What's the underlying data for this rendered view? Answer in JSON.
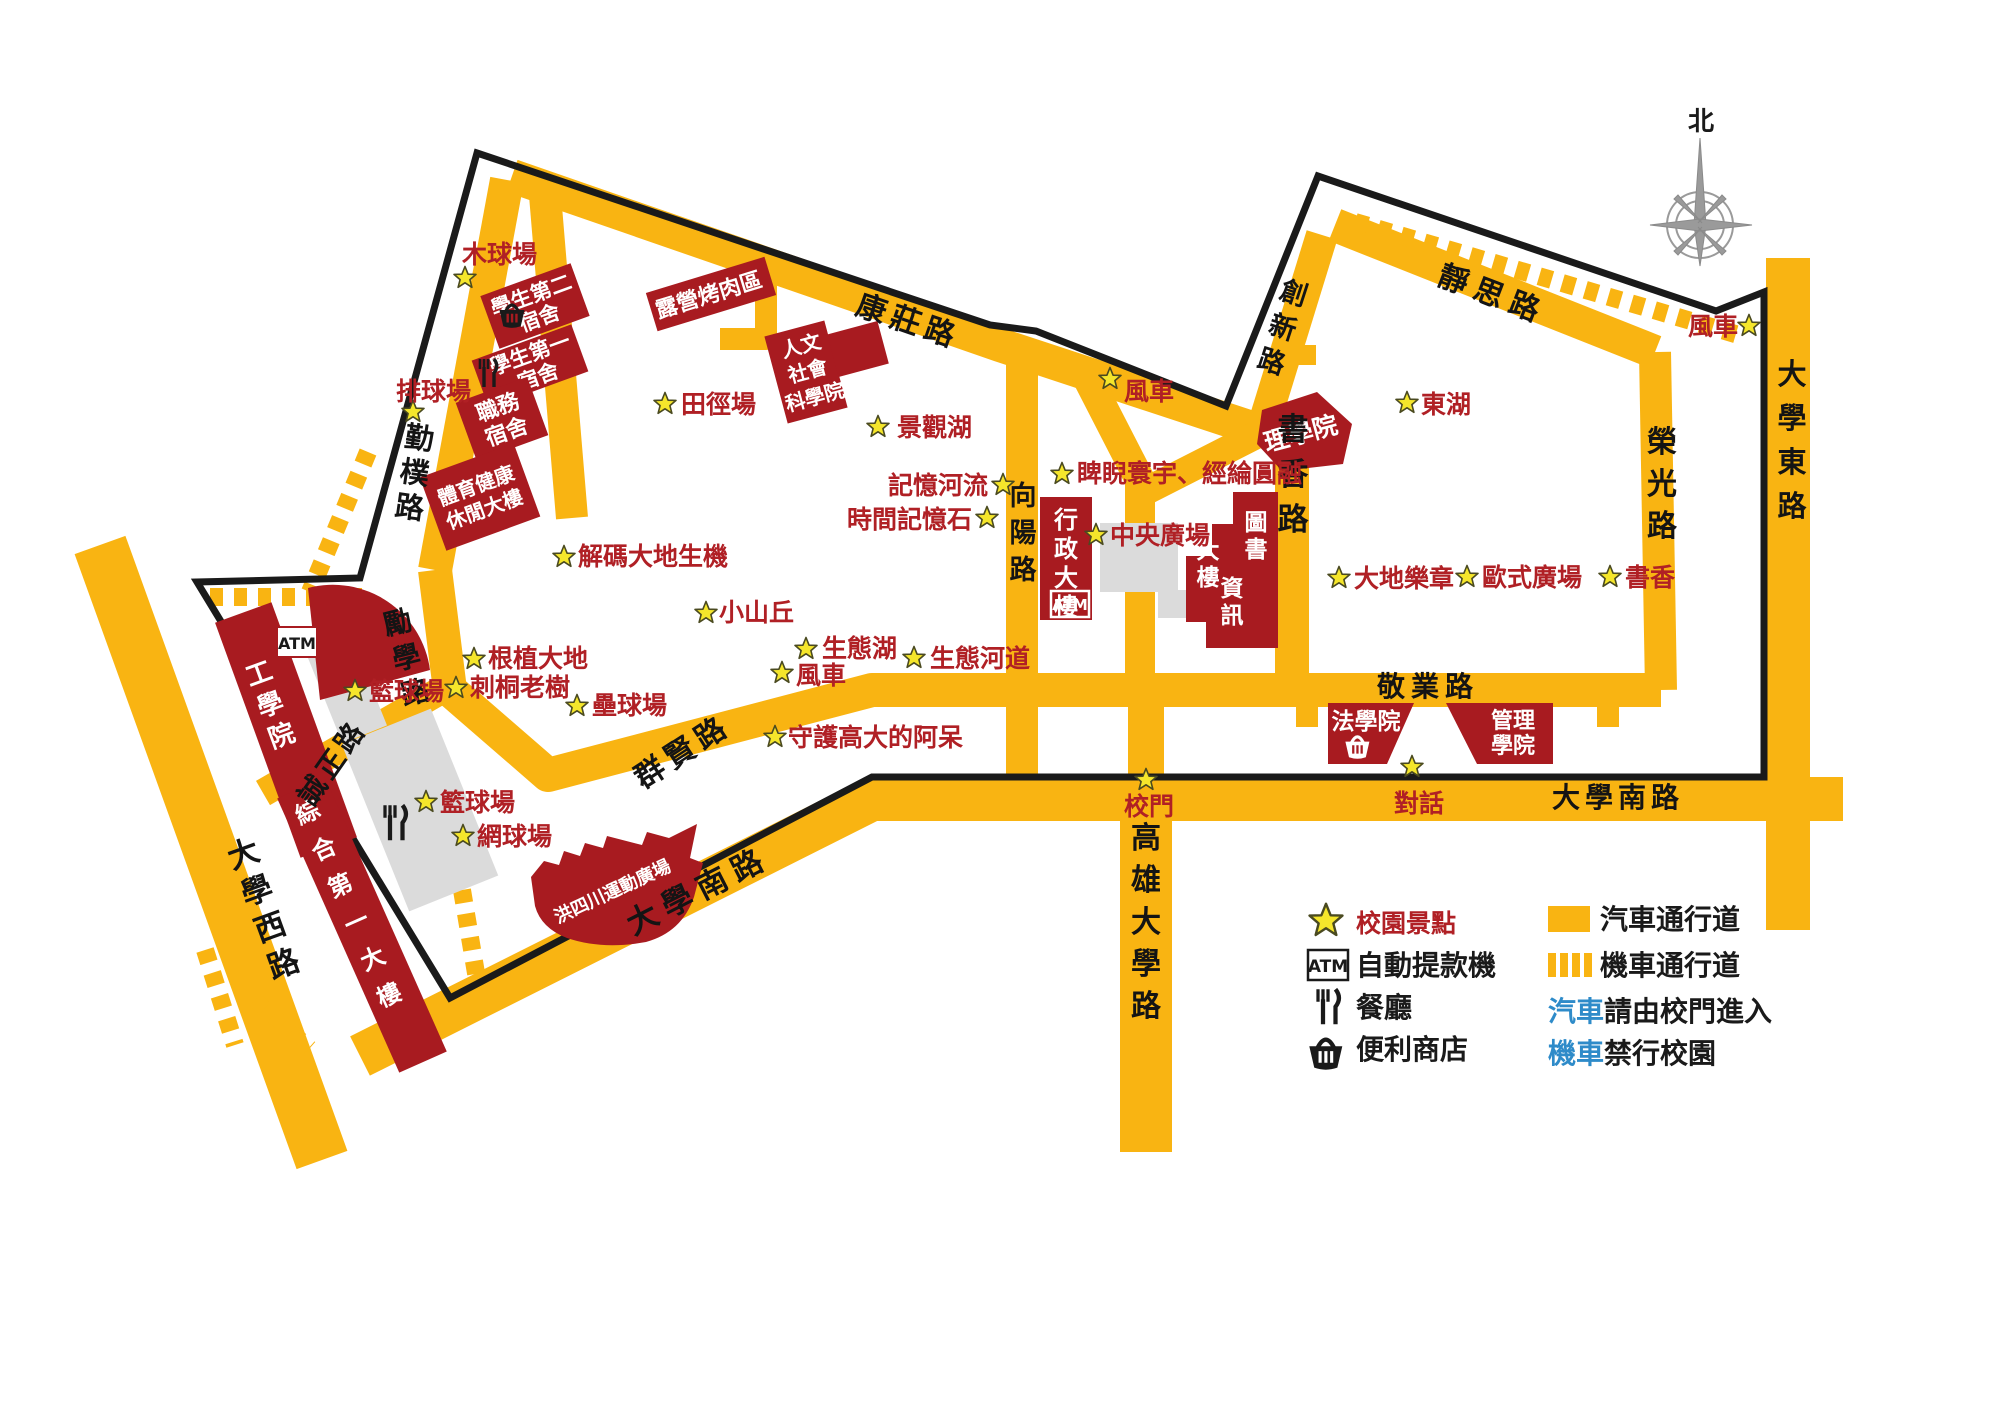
{
  "compass": {
    "north": "北"
  },
  "colors": {
    "road_yellow": "#F9B412",
    "building_red": "#A81B20",
    "label_red": "#B02025",
    "star_yellow": "#F5E62B",
    "note_blue": "#2E8BC9",
    "plaza_gray": "#DBDBDB",
    "boundary_black": "#1A1A1A"
  },
  "roads": {
    "qinpu": "勤樸路",
    "kangzhuang": "康莊路",
    "lixue": "勵學路",
    "chengzheng": "誠正路",
    "qunxian": "群賢路",
    "xiangyang": "向陽路",
    "chuangxin": "創新路",
    "shuxiang": "書香路",
    "jingsi": "靜思路",
    "rongguang": "榮光路",
    "jingye": "敬業路",
    "daxue_south": "大學南路",
    "daxue_west": "大學西路",
    "daxue_east": "大學東路",
    "gaoxiong": "高雄大學路"
  },
  "buildings": {
    "dorm2": {
      "l1": "學生第二",
      "l2": "宿舍"
    },
    "dorm1": {
      "l1": "學生第一",
      "l2": "宿舍"
    },
    "staff": {
      "l1": "職務",
      "l2": "宿舍"
    },
    "gym": {
      "l1": "體育健康",
      "l2": "休閒大樓"
    },
    "camp": {
      "l1": "露營烤肉區"
    },
    "hum": {
      "l1": "人文",
      "l2": "社會",
      "l3": "科學院"
    },
    "sci": {
      "l1": "理學院"
    },
    "admin": {
      "name": "行政大樓",
      "atm": "ATM"
    },
    "lib": {
      "c1": "圖書",
      "c2": "資訊",
      "c3": "大樓"
    },
    "law": {
      "l1": "法學院"
    },
    "mgmt": {
      "l1": "管理",
      "l2": "學院"
    },
    "eng": {
      "name": "工學院",
      "atm": "ATM"
    },
    "zonghe": {
      "name": "綜合第一大樓"
    },
    "ship": {
      "name": "洪四川運動廣場"
    }
  },
  "spots": {
    "muqiu": "木球場",
    "paiqiu": "排球場",
    "tianjing": "田徑場",
    "jingguanhu": "景觀湖",
    "jiyiheliu": "記憶河流",
    "shijian": "時間記憶石",
    "pini": "睥睨寰宇、經綸圓融",
    "fengche1": "風車",
    "fengche2": "風車",
    "fengche3": "風車",
    "donghu": "東湖",
    "jiema": "解碼大地生機",
    "xiaoshanqiu": "小山丘",
    "genzhi": "根植大地",
    "citong": "刺桐老樹",
    "leiqiu": "壘球場",
    "lanqiu1": "籃球場",
    "lanqiu2": "籃球場",
    "wangqiu": "網球場",
    "shengtaihu": "生態湖",
    "shengtaihedao": "生態河道",
    "shouhu": "守護高大的阿呆",
    "zhongyang": "中央廣場",
    "xiaomen": "校門",
    "duihua": "對話",
    "dadi": "大地樂章",
    "oushi": "歐式廣場",
    "shuxiang_spot": "書香"
  },
  "legend": {
    "spot_label": "校園景點",
    "atm_abbr": "ATM",
    "atm_label": "自動提款機",
    "restaurant_label": "餐廳",
    "store_label": "便利商店",
    "car_road_label": "汽車通行道",
    "moto_road_label": "機車通行道",
    "car_note_highlight": "汽車",
    "car_note": "請由校門進入",
    "moto_note_highlight": "機車",
    "moto_note": "禁行校園"
  }
}
